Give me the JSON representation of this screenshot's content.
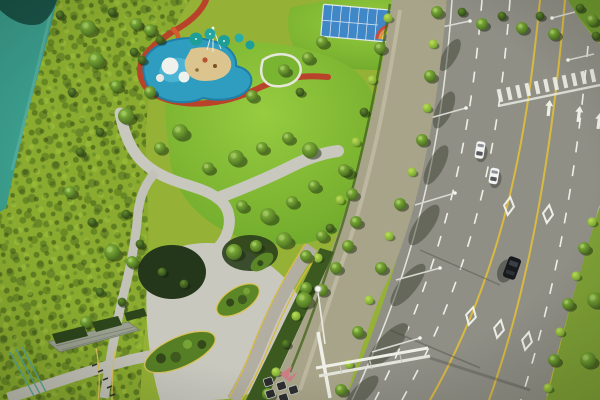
{
  "image": {
    "type": "aerial-drone-photograph",
    "title": "Aerial view of a landscaped city park beside a curving multi-lane road",
    "width_px": 600,
    "height_px": 400,
    "description": "Bird's-eye drone photo. Left: teal pond and a densely vegetated wild bank. Top: children's splash-pad playground with teal canopies, sand pit and a winding red track; multi-sport courts with a rainbow-striped surface; dark glass buildings. Center: bright mounded lawn ringed by curving grey footpaths, tree clusters and oval shrub islands with yellow curbs. Right: tree-lined sidewalk buffer, then a wide curving road with two white cars, one black SUV, dashed lanes, yellow edge lines, diamond markings, straight arrows and a zebra crosswalk."
  },
  "scene": {
    "regions": [
      {
        "name": "pond",
        "description": "teal pond water in top-left corner with dark tree shadows at its top edge"
      },
      {
        "name": "wild-bank",
        "description": "dense yellow-green wild vegetation band along the left side"
      },
      {
        "name": "splash-playground",
        "description": "blue splash pad with white islands, sand play area, teal shade canopies and a rope-climbing mast"
      },
      {
        "name": "red-track",
        "description": "red-brown winding jogging track looping around the playground"
      },
      {
        "name": "sport-courts",
        "description": "blue courts with white lines and a rainbow-striped arc surface, top edge"
      },
      {
        "name": "buildings",
        "description": "dark glass building facades along the top edge"
      },
      {
        "name": "central-lawn",
        "description": "bright green mounded lawn in the park center"
      },
      {
        "name": "path-network",
        "description": "light grey curving footpaths and a wide lower plaza"
      },
      {
        "name": "planting-islands",
        "description": "oval shrub islands with yellow curb edging set in the plaza"
      },
      {
        "name": "tree-buffer",
        "description": "sidewalk strip with staked street trees between park and road"
      },
      {
        "name": "internal-road",
        "description": "small park road with yellow edge lines reaching the bottom edge"
      },
      {
        "name": "main-road",
        "description": "wide multi-lane road sweeping down the right side"
      },
      {
        "name": "crosswalk",
        "description": "white zebra crossing near the top of the road"
      },
      {
        "name": "right-verge",
        "description": "green tree verge along the lower right road edge"
      },
      {
        "name": "terrace",
        "description": "bottom-left terrace with retaining wall, hedge boxes and teal railing"
      }
    ]
  },
  "park": {
    "features": [
      "teal shade canopies",
      "climbing mast with guy ropes",
      "sand play area",
      "white splash islands",
      "winding red jogging track",
      "rainbow-striped court surface",
      "oval shrub islands with yellow curbs",
      "street trees with support stakes",
      "overhead sign gantry",
      "streetlights",
      "pedestrian railing",
      "hedge boxes"
    ]
  },
  "road": {
    "carriageways": 2,
    "diamond_markings": 5,
    "straight_arrows": 3,
    "crosswalk_stripes": 11,
    "solid_yellow_lines": 2,
    "dashed_white_lines": true,
    "vehicles": [
      {
        "type": "white-car",
        "x": 480,
        "y": 150
      },
      {
        "type": "white-car",
        "x": 494,
        "y": 176
      },
      {
        "type": "black-suv",
        "x": 512,
        "y": 268
      }
    ]
  },
  "colors": {
    "grass_base": "#95b236",
    "wild_band": "#8aab2f",
    "lawn_green": "#7cb52f",
    "pond_teal": "#3a9c8b",
    "pond_shadow": "#14463c",
    "splash_water": "#2e9dbf",
    "splash_water_light": "#4fb7d6",
    "sand": "#dcc48e",
    "white_deck": "#eff1ec",
    "track_red": "#b8432a",
    "slide_orange": "#d15c2e",
    "canopy_teal": "#1d9e96",
    "court_blue": "#3f87c6",
    "rainbow": [
      "#cf4a3a",
      "#e2943e",
      "#e8d44e",
      "#8d68ac",
      "#42aaa0"
    ],
    "building_dark": "#16211a",
    "road_asphalt": "#908f86",
    "lane_white": "#eef0e8",
    "lane_yellow": "#d9ba41",
    "path_gray": "#c9c8bf",
    "sidewalk_tan": "#a8a489",
    "hedge_green": "#3c5a20",
    "island_green": "#5c8727",
    "curb_yellow": "#d9c35a",
    "car_white": "#f3f4f1",
    "car_black": "#17191c",
    "pole_gray": "#d7d9d2",
    "tree_dark": "#466a20",
    "tree_bright": "#a5cf49"
  }
}
